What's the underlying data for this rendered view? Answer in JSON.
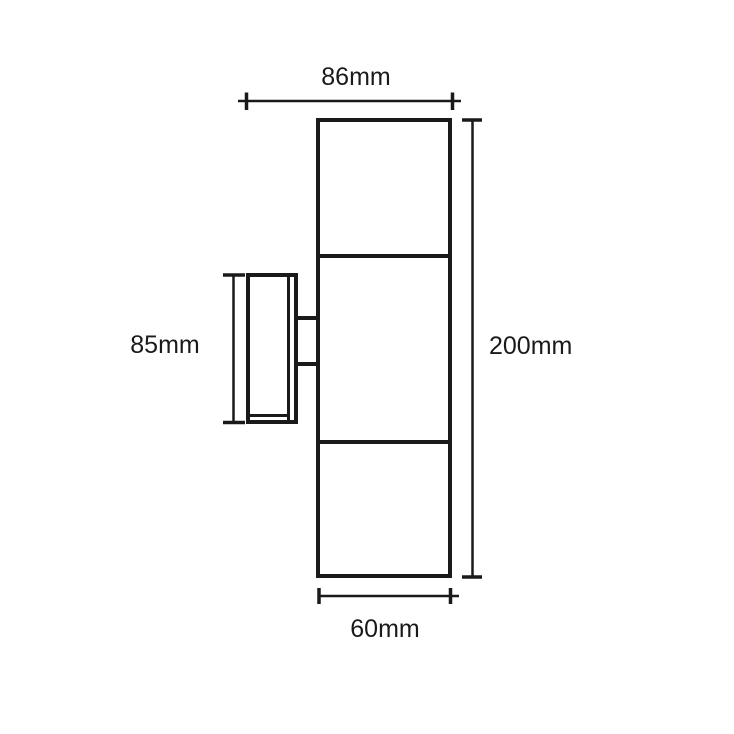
{
  "page": {
    "background": "#ffffff",
    "line_color": "#1a1a1a"
  },
  "drawing": {
    "kind": "wall-light-dimension-drawing",
    "dimensions": {
      "top_width": {
        "label": "86mm"
      },
      "right_height": {
        "label": "200mm"
      },
      "left_bracket_height": {
        "label": "85mm"
      },
      "bottom_width": {
        "label": "60mm"
      }
    }
  }
}
